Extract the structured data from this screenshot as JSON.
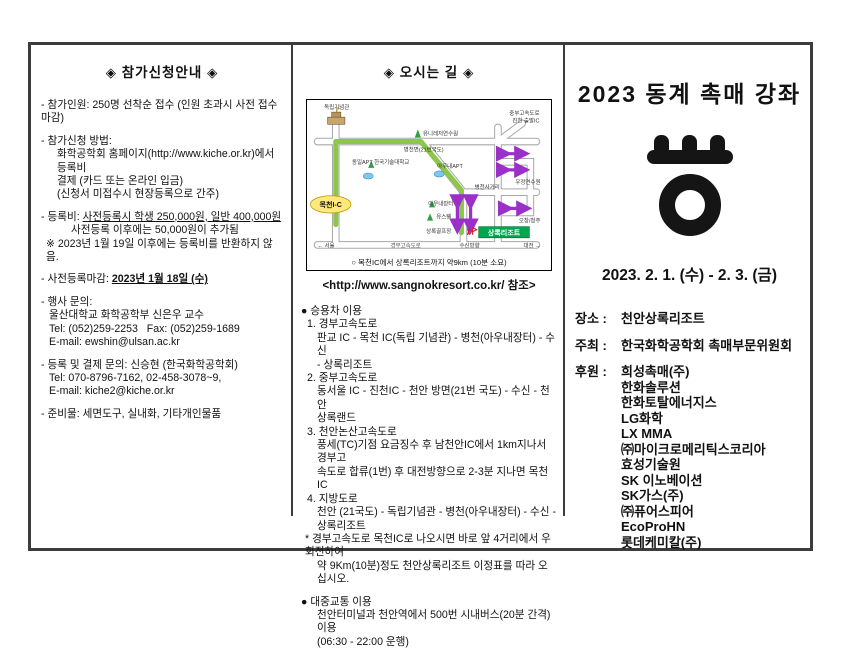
{
  "left": {
    "title": "◈ 참가신청안내 ◈",
    "lines": [
      {
        "text": "- 참가인원: 250명 선착순 접수 (인원 초과시 사전 접수 마감)"
      },
      {
        "cls": "gap"
      },
      {
        "text": "- 참가신청 방법:"
      },
      {
        "cls": "ind",
        "text": "화학공학회 홈페이지(http://www.kiche.or.kr)에서 등록비"
      },
      {
        "cls": "ind",
        "text": "결제 (카드 또는 온라인 입금)"
      },
      {
        "cls": "ind",
        "text": "(신청서 미접수시 현장등록으로 간주)"
      },
      {
        "cls": "gap"
      },
      {
        "segs": [
          {
            "t": "- 등록비: "
          },
          {
            "t": "사전등록시 학생 250,000원, 일반 400,000원",
            "u": 1
          }
        ]
      },
      {
        "cls": "ind2",
        "text": "사전등록 이후에는 50,000원이 추가됨"
      },
      {
        "cls": "xs",
        "text": "※ 2023년 1월 19일 이후에는 등록비를 반환하지 않음."
      },
      {
        "cls": "gap"
      },
      {
        "segs": [
          {
            "t": "- 사전등록마감: "
          },
          {
            "t": "2023년 1월 18일 (수)",
            "u": 1,
            "b": 1
          }
        ]
      },
      {
        "cls": "gap"
      },
      {
        "text": "- 행사 문의:"
      },
      {
        "cls": "ind-s",
        "text": "울산대학교 화학공학부 신은우 교수"
      },
      {
        "cls": "ind-s",
        "text": "Tel: (052)259-2253   Fax: (052)259-1689"
      },
      {
        "cls": "ind-s",
        "text": "E-mail: ewshin@ulsan.ac.kr"
      },
      {
        "cls": "gap"
      },
      {
        "text": "- 등록 및 결제 문의: 신승현 (한국화학공학회)"
      },
      {
        "cls": "ind-s",
        "text": "Tel: 070-8796-7162, 02-458-3078~9,"
      },
      {
        "cls": "ind-s",
        "text": "E-mail: kiche2@kiche.or.kr"
      },
      {
        "cls": "gap"
      },
      {
        "text": "- 준비물: 세면도구, 실내화, 기타개인물품"
      }
    ]
  },
  "middle": {
    "title": "◈ 오시는 길 ◈",
    "map": {
      "caption": "○ 목천IC에서 상록리조트까지 약9km (10분 소요)",
      "labels": {
        "memorial": "독립기념관",
        "ic": "목천I-C",
        "training": "유니레저연수원",
        "road21": "병천면(21번국도)",
        "apt1": "동일APT 한국기술대학교",
        "apt2": "아우내APT",
        "jungbu1": "중부고속도로",
        "jungbu2": "진천 출발IC",
        "postal": "우정연수원",
        "crossroad": "병천사거리",
        "market": "아우내장터",
        "youth": "유스텔",
        "golf": "상록골프장",
        "resort": "상록리조트",
        "ochang": "오창/청주",
        "susin": "수신방향",
        "gyeongbu": "경부고속도로",
        "seoul": "← 서울",
        "daejeon": "대전 →"
      }
    },
    "website_ref": "<http://www.sangnokresort.co.kr/ 참조>",
    "lines": [
      {
        "text": "● 승용차 이용"
      },
      {
        "cls": "num",
        "text": "1. 경부고속도로"
      },
      {
        "cls": "ind",
        "text": "판교 IC - 목천 IC(독립 기념관) - 병천(아우내장터) - 수신"
      },
      {
        "cls": "ind",
        "text": "- 상록리조트"
      },
      {
        "cls": "num",
        "text": "2. 중부고속도로"
      },
      {
        "cls": "ind",
        "text": "동서울 IC - 진천IC - 천안 방면(21번 국도) - 수신 - 천안"
      },
      {
        "cls": "ind",
        "text": "상록랜드"
      },
      {
        "cls": "num",
        "text": "3. 천안논산고속도로"
      },
      {
        "cls": "ind",
        "text": "풍세(TC)기점 요금징수 후 남천안IC에서 1km지나서 경부고"
      },
      {
        "cls": "ind",
        "text": "속도로 합류(1번) 후 대전방향으로 2-3분 지나면 목천IC"
      },
      {
        "cls": "num",
        "text": "4. 지방도로"
      },
      {
        "cls": "ind",
        "text": "천안 (21국도) - 독립기념관 - 병천(아우내장터) - 수신 -"
      },
      {
        "cls": "ind",
        "text": "상록리조트"
      },
      {
        "cls": "star",
        "text": "* 경부고속도로 목천IC로 나오시면 바로 앞 4거리에서 우회전하여"
      },
      {
        "cls": "ind",
        "text": "약 9Km(10분)정도 천안상록리조트 이정표를 따라 오십시오."
      },
      {
        "cls": "gap"
      },
      {
        "text": "● 대중교통 이용"
      },
      {
        "cls": "ind",
        "text": "천안터미널과 천안역에서 500번 시내버스(20분 간격) 이용"
      },
      {
        "cls": "ind",
        "text": "(06:30 - 22:00 운행)"
      }
    ]
  },
  "right": {
    "title": "2023 동계 촉매 강좌",
    "date": "2023. 2. 1. (수) - 2. 3. (금)",
    "venue_label": "장소 :",
    "venue": "천안상록리조트",
    "host_label": "주최 :",
    "host": "한국화학공학회 촉매부문위원회",
    "sponsor_label": "후원 :",
    "sponsors": [
      "희성촉매(주)",
      "한화솔루션",
      "한화토탈에너지스",
      "LG화학",
      "LX MMA",
      "㈜마이크로메리틱스코리아",
      "효성기술원",
      "SK 이노베이션",
      "SK가스(주)",
      "㈜퓨어스피어",
      "EcoProHN",
      "롯데케미칼(주)"
    ]
  },
  "colors": {
    "route_green": "#86c440",
    "arrow_purple": "#9b30c8",
    "ic_yellow": "#ffe97a",
    "resort_green": "#00a650",
    "border_dark": "#3c3c3c"
  }
}
